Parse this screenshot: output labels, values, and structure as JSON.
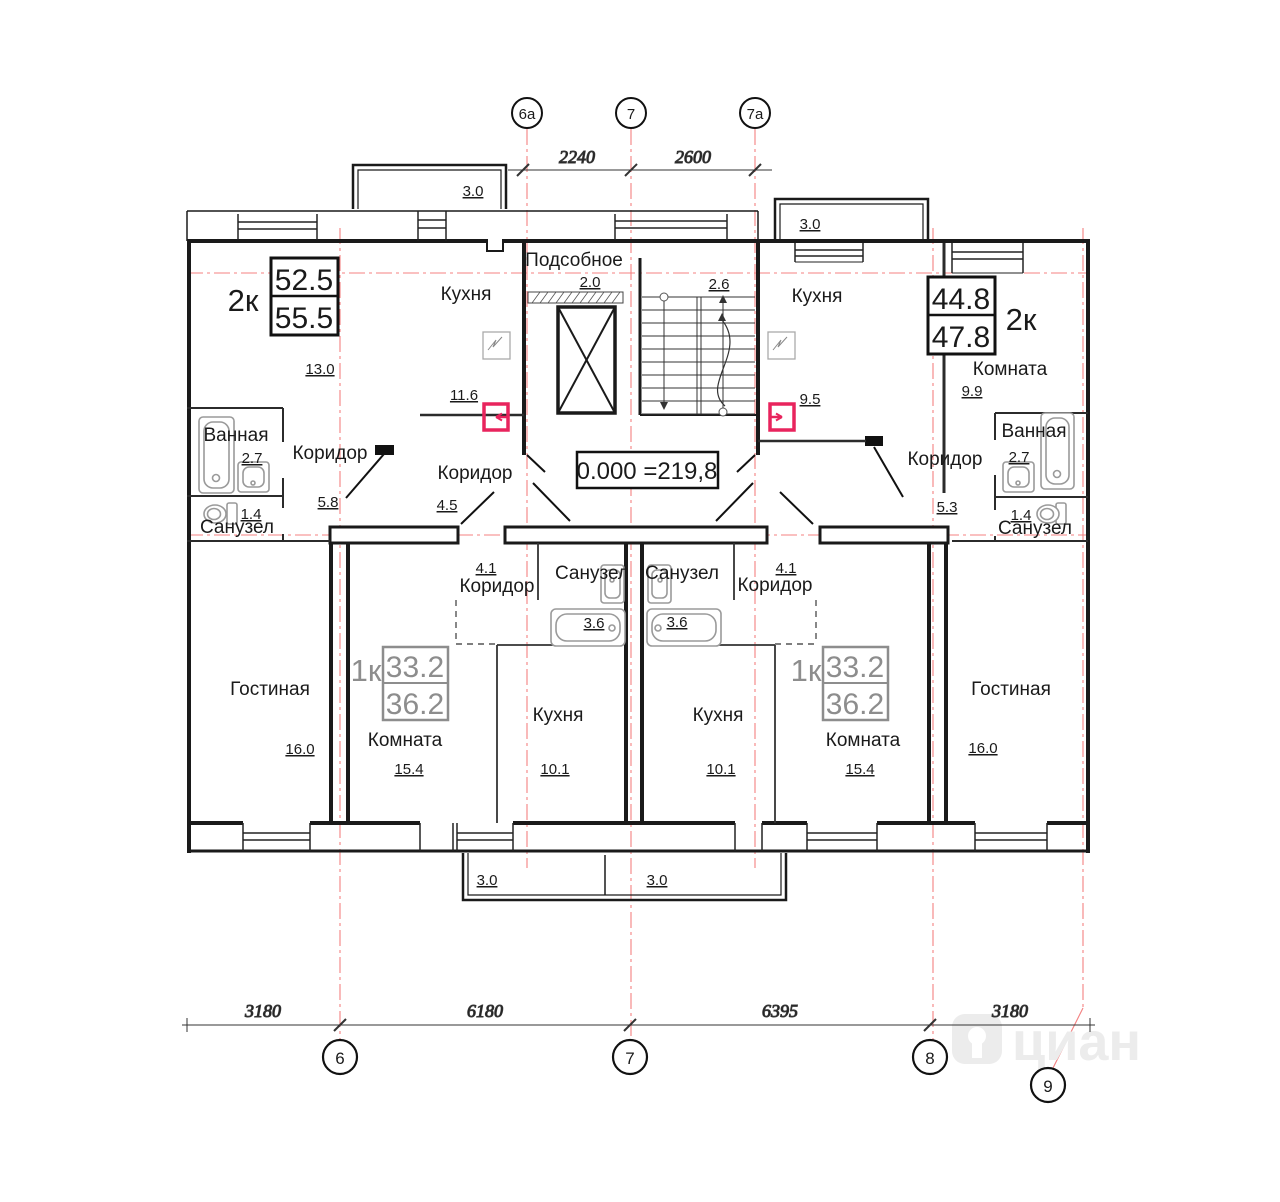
{
  "plan": {
    "elevation": "0.000 =219,8",
    "watermark": "циан"
  },
  "axes": {
    "top": [
      "6а",
      "7",
      "7а"
    ],
    "bottom": [
      "6",
      "7",
      "8",
      "9"
    ]
  },
  "dims": {
    "top": [
      "2240",
      "2600"
    ],
    "bottom": [
      "3180",
      "6180",
      "6395",
      "3180"
    ]
  },
  "apartments": {
    "left2k": {
      "type": "2к",
      "area1": "52.5",
      "area2": "55.5"
    },
    "right2k": {
      "type": "2к",
      "area1": "44.8",
      "area2": "47.8"
    },
    "left1k": {
      "type": "1к",
      "area1": "33.2",
      "area2": "36.2"
    },
    "right1k": {
      "type": "1к",
      "area1": "33.2",
      "area2": "36.2"
    }
  },
  "rooms": {
    "podsobnoe": {
      "name": "Подсобное",
      "area": "2.0"
    },
    "stairs": {
      "area": "2.6"
    },
    "room_l2k": {
      "area": "13.0"
    },
    "kitchen_l2k": {
      "name": "Кухня",
      "area": "11.6"
    },
    "bath_l2k": {
      "name": "Ванная",
      "area": "2.7"
    },
    "wc_l2k": {
      "name": "Санузел",
      "area": "1.4"
    },
    "hall1_l2k": {
      "name": "Коридор",
      "area": "5.8"
    },
    "hall2_l2k": {
      "name": "Коридор",
      "area": "4.5"
    },
    "living_l2k": {
      "name": "Гостиная",
      "area": "16.0"
    },
    "kitchen_r2k": {
      "name": "Кухня",
      "area": "9.5"
    },
    "room_r2k": {
      "name": "Комната",
      "area": "9.9"
    },
    "bath_r2k": {
      "name": "Ванная",
      "area": "2.7"
    },
    "wc_r2k": {
      "name": "Санузел",
      "area": "1.4"
    },
    "hall_r2k": {
      "name": "Коридор",
      "area": "5.3"
    },
    "living_r2k": {
      "name": "Гостиная",
      "area": "16.0"
    },
    "hall_l1k": {
      "name": "Коридор",
      "area": "4.1"
    },
    "wc_l1k": {
      "name": "Санузел",
      "area": "3.6"
    },
    "room_l1k": {
      "name": "Комната",
      "area": "15.4"
    },
    "kitchen_l1k": {
      "name": "Кухня",
      "area": "10.1"
    },
    "hall_r1k": {
      "name": "Коридор",
      "area": "4.1"
    },
    "wc_r1k": {
      "name": "Санузел",
      "area": "3.6"
    },
    "room_r1k": {
      "name": "Комната",
      "area": "15.4"
    },
    "kitchen_r1k": {
      "name": "Кухня",
      "area": "10.1"
    }
  },
  "balconies": {
    "top_left": "3.0",
    "top_right": "3.0",
    "bottom_left": "3.0",
    "bottom_right": "3.0"
  },
  "colors": {
    "wall": "#1a1a1a",
    "axis_red": "#f48080",
    "door_red": "#e8245d",
    "fixture_gray": "#9a9a9a",
    "annotation_gray": "#8d8d8d"
  }
}
